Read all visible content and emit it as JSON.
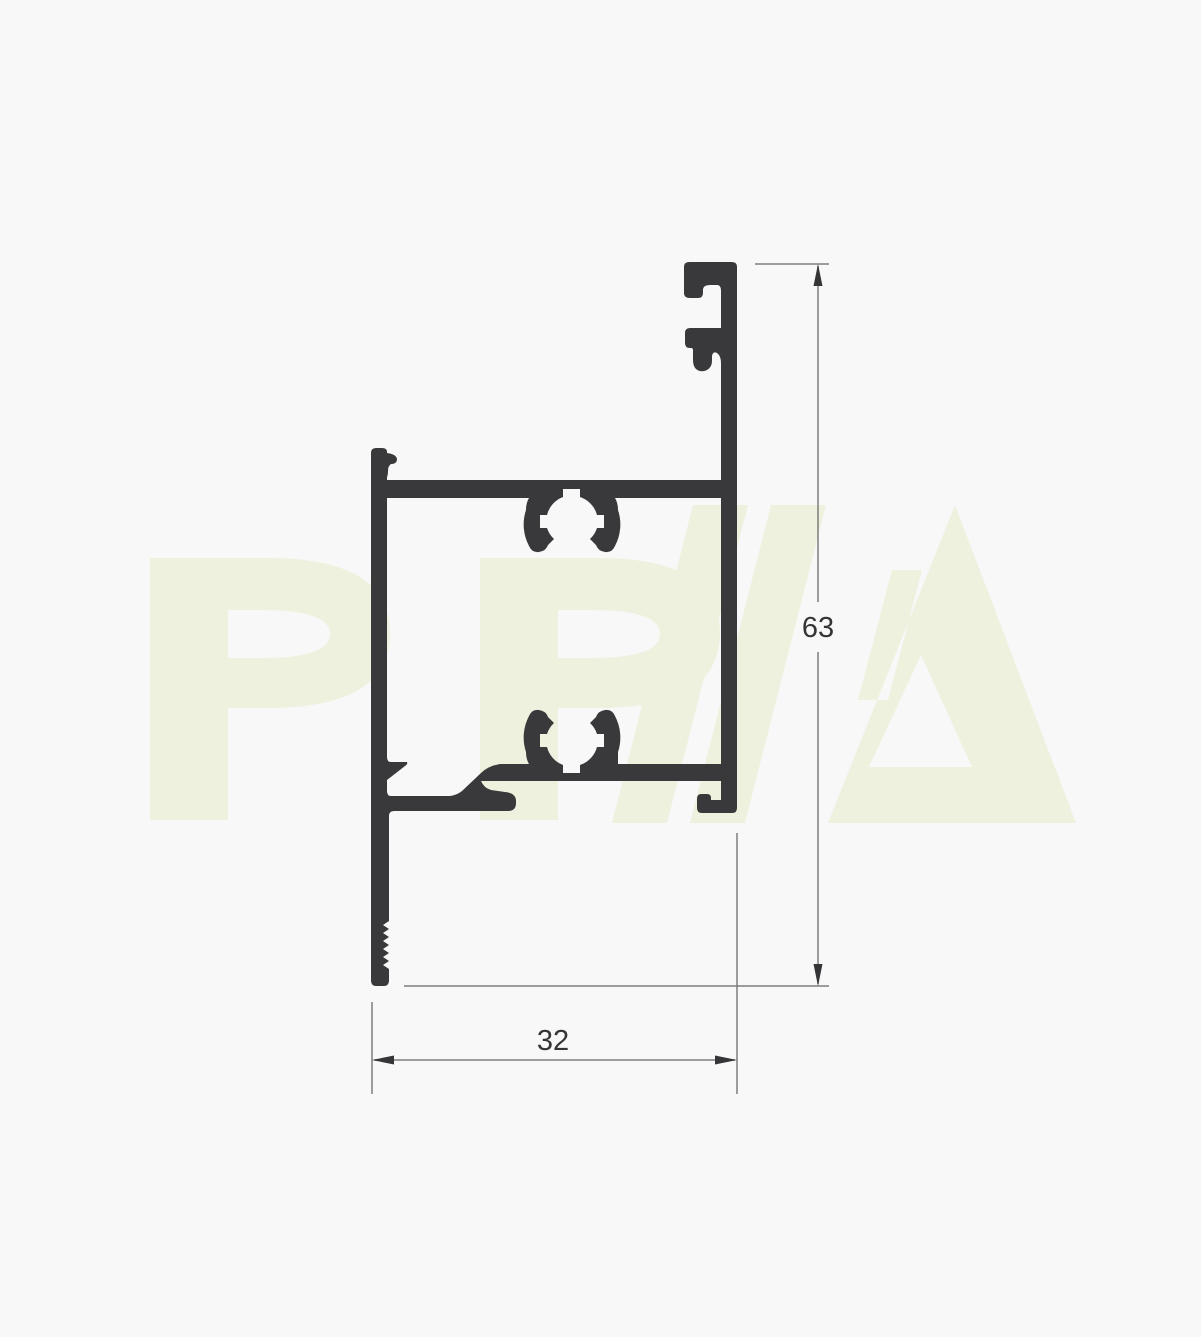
{
  "drawing": {
    "kind": "aluminium-profile-cross-section"
  },
  "watermark": {
    "text": "PPA",
    "color": "#edf1de"
  },
  "dimensions": {
    "height": {
      "value": "63"
    },
    "width": {
      "value": "32"
    }
  },
  "colors": {
    "background": "#f8f8f8",
    "profile": "#39393b",
    "dimension_line": "#7d7d7d",
    "dimension_arrow": "#353537",
    "dimension_text": "#353537"
  }
}
